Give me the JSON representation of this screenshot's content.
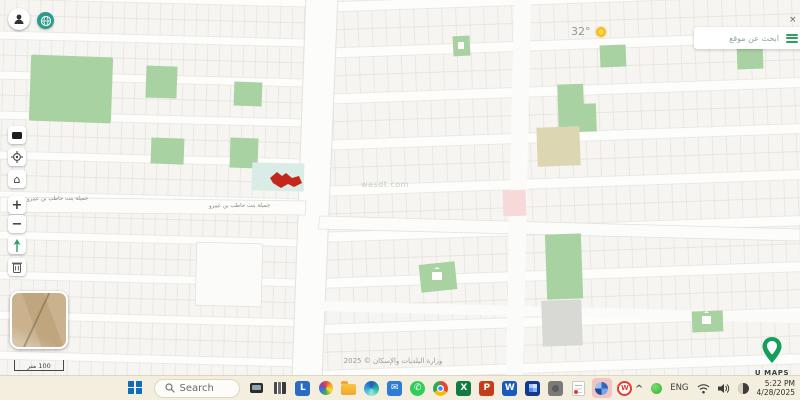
{
  "app": {
    "name": "U MAPS"
  },
  "map": {
    "weather_temp": "32°",
    "search_placeholder": "ابحث عن موقع",
    "search_close": "×",
    "street_label": "جميلة بنت حاطب بن عمرو",
    "watermark": "wasdt.com",
    "scale_label": "100 متر",
    "copyright": "وزارة البلديات والإسكان © 2025",
    "logo_text": "U MAPS",
    "zoom_in_label": "+",
    "zoom_out_label": "−",
    "home_glyph": "⌂",
    "colors": {
      "park_green": "#a9d2a2",
      "khaki_parcel": "#dcd7b2",
      "selected_parcel_red": "#c3271c",
      "pink_parcel": "#f6d9d8",
      "teal_highlight": "#daece6",
      "road_white": "#fcfcfa",
      "lot_line": "#e2e0da",
      "brand_green": "#159f5c",
      "gray_parcel": "#d8d8d5"
    },
    "toolbar_icons": [
      "legend-icon",
      "locate-icon",
      "home-icon",
      "zoom-in",
      "zoom-out",
      "north-arrow-icon",
      "trash-icon"
    ]
  },
  "taskbar": {
    "search_placeholder": "Search",
    "icons": [
      "laptop",
      "documents",
      "libreoffice",
      "photos",
      "file-explorer",
      "edge",
      "mail",
      "whatsapp",
      "chrome",
      "excel",
      "powerpoint",
      "word",
      "blue-app",
      "gray-app",
      "notes",
      "active-app",
      "wps-office"
    ],
    "letters": {
      "libreoffice": "L",
      "excel": "X",
      "powerpoint": "P",
      "word": "W",
      "wps": "W"
    },
    "glyphs": {
      "mail": "✉",
      "whatsapp": "✆",
      "chevron": "^"
    },
    "tray": {
      "language": "ENG",
      "time": "5:22 PM",
      "date": "4/28/2025"
    }
  }
}
